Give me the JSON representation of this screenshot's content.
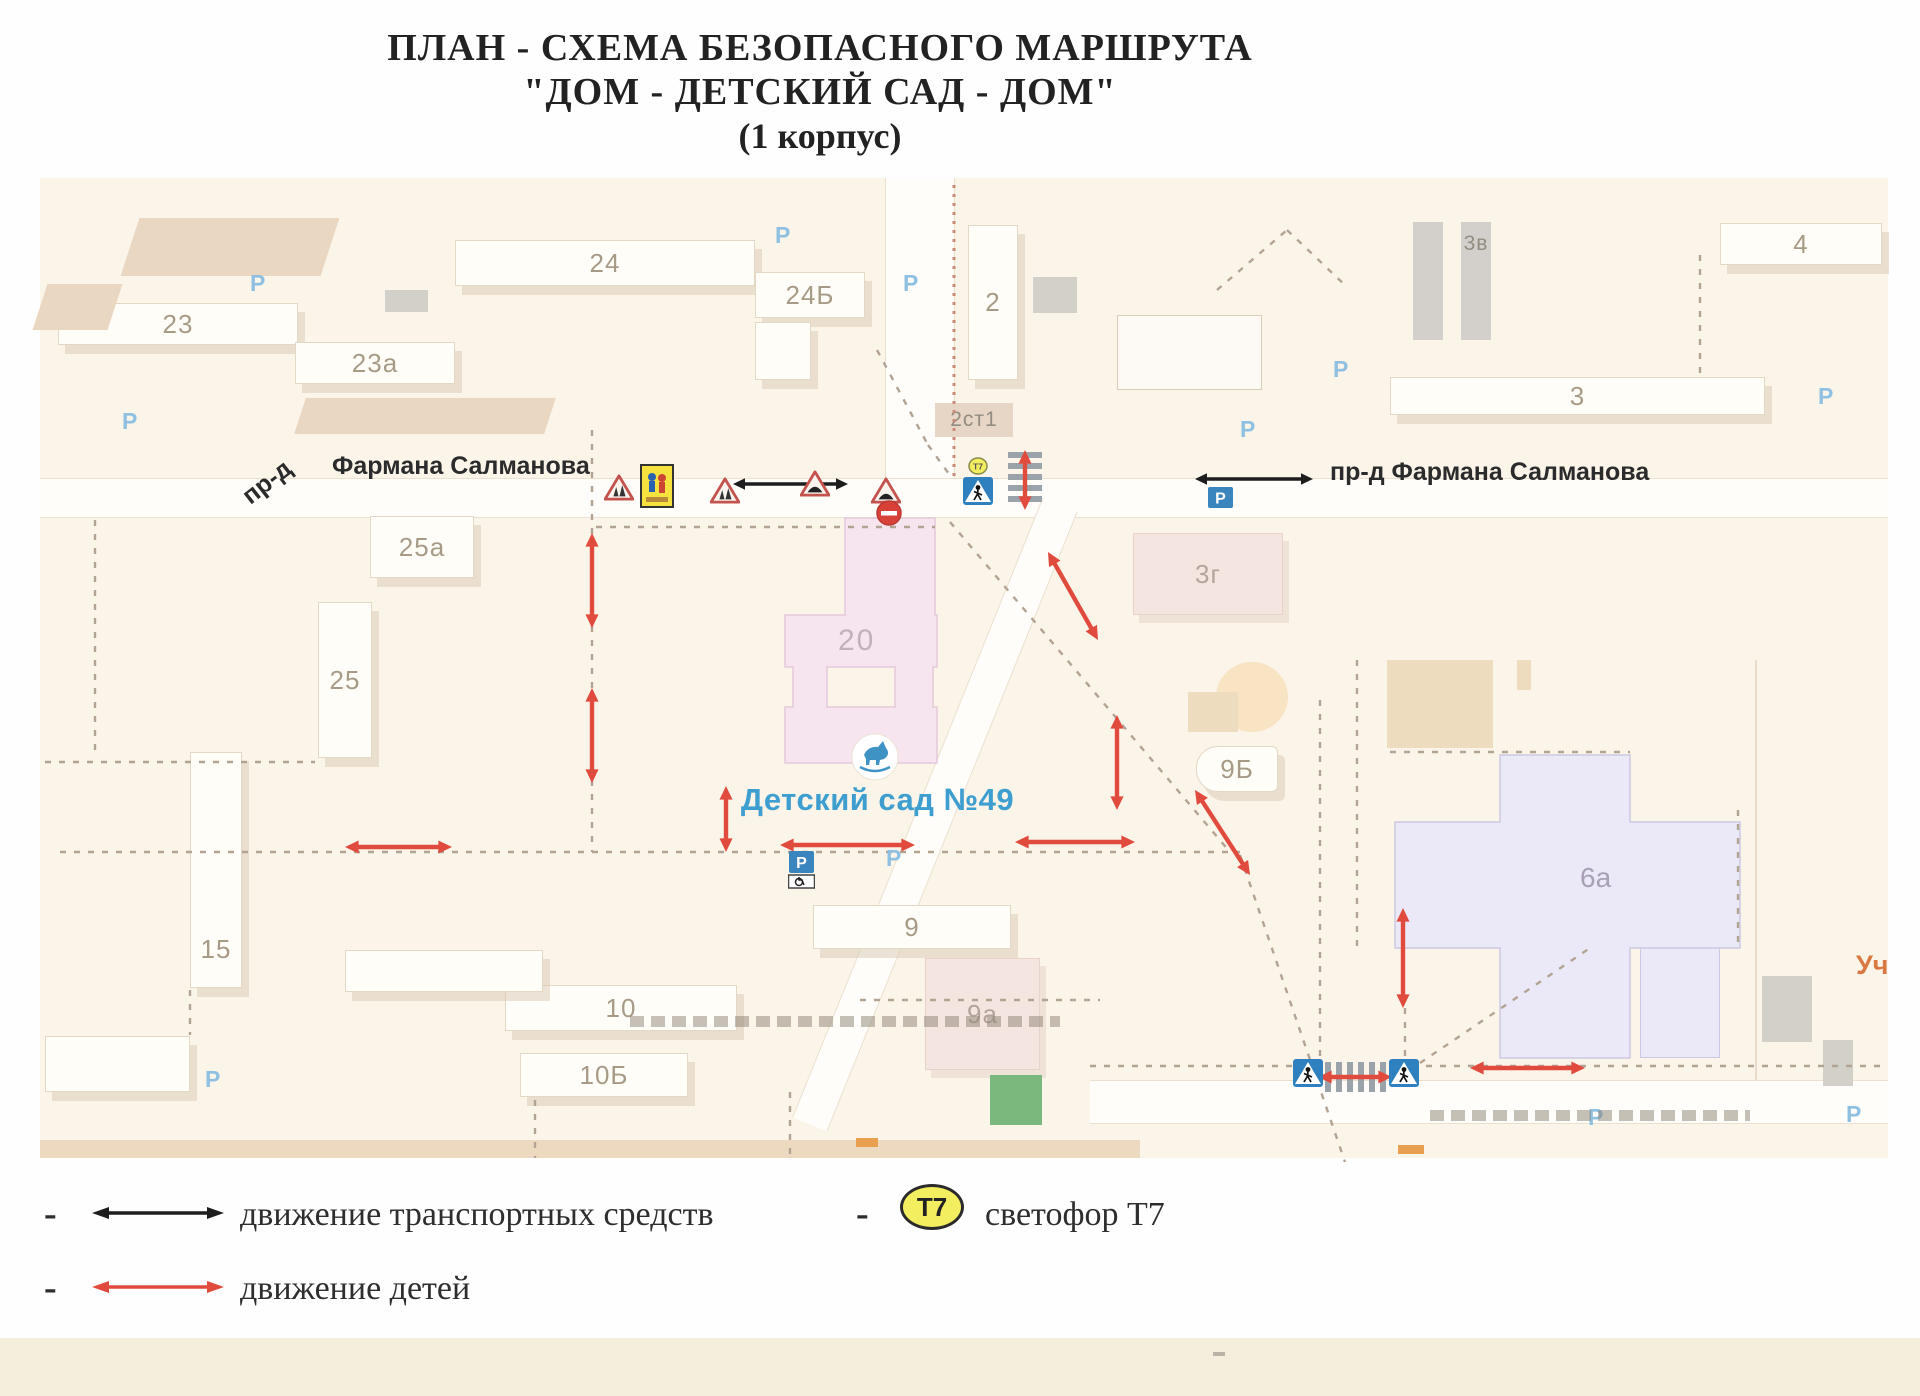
{
  "title": {
    "line1": "ПЛАН - СХЕМА БЕЗОПАСНОГО МАРШРУТА",
    "line2": "\"ДОМ - ДЕТСКИЙ САД - ДОМ\"",
    "line3": "(1 корпус)"
  },
  "legend": {
    "dash": "-",
    "vehicles_label": "движение транспортных средств",
    "children_label": "движение детей",
    "t7_label": "светофор Т7",
    "t7_badge": "Т7"
  },
  "colors": {
    "map_bg": "#fbf4e9",
    "road": "#fefdf9",
    "dash": "#b3a393",
    "red_dotted": "#cc8b7a",
    "thin": "#e2d5c2",
    "arrow_red": "#e14b3e",
    "arrow_black": "#1d1d1d",
    "zebra": "#9aa2aa",
    "kindergarten_blue": "#3d9ecf",
    "parking_blue": "#3a85bd",
    "faint_p": "#8fc0e2",
    "t7_yellow": "#f3ee5f"
  },
  "map": {
    "street_left_prefix": "пр-д",
    "street_left": "Фармана Салманова",
    "street_right": "пр-д Фармана Салманова",
    "kindergarten_label": "Детский сад №49",
    "edge_label": "Уч",
    "p_char": "P",
    "t7_badge": "Т7",
    "roads": [
      {
        "x": 40,
        "y": 478,
        "w": 1848,
        "h": 40
      },
      {
        "x": 885,
        "y": 178,
        "w": 70,
        "h": 300,
        "v": true
      },
      {
        "x": 1090,
        "y": 1080,
        "w": 798,
        "h": 44
      },
      {
        "x": 1041,
        "y": 505,
        "w": 38,
        "h": 668,
        "v": true,
        "rot": 22
      }
    ],
    "buildings": [
      {
        "label": "23",
        "x": 58,
        "y": 303,
        "w": 240,
        "h": 42,
        "t": "white"
      },
      {
        "label": "23а",
        "x": 295,
        "y": 342,
        "w": 160,
        "h": 42,
        "t": "white"
      },
      {
        "label": "24",
        "x": 455,
        "y": 240,
        "w": 300,
        "h": 46,
        "t": "white"
      },
      {
        "label": "24Б",
        "x": 755,
        "y": 272,
        "w": 110,
        "h": 46,
        "t": "white"
      },
      {
        "label": "",
        "x": 755,
        "y": 322,
        "w": 56,
        "h": 58,
        "t": "white"
      },
      {
        "label": "2",
        "x": 968,
        "y": 225,
        "w": 50,
        "h": 155,
        "t": "white"
      },
      {
        "label": "2ст1",
        "x": 935,
        "y": 403,
        "w": 78,
        "h": 34,
        "t": "tanlabel"
      },
      {
        "label": "",
        "x": 1413,
        "y": 222,
        "w": 30,
        "h": 118,
        "t": "graybar"
      },
      {
        "label": "3в",
        "x": 1461,
        "y": 222,
        "w": 30,
        "h": 118,
        "t": "graybar",
        "la": "top"
      },
      {
        "label": "3",
        "x": 1390,
        "y": 377,
        "w": 375,
        "h": 38,
        "t": "white"
      },
      {
        "label": "4",
        "x": 1720,
        "y": 223,
        "w": 162,
        "h": 42,
        "t": "white"
      },
      {
        "label": "",
        "x": 1117,
        "y": 315,
        "w": 145,
        "h": 75,
        "t": "outline"
      },
      {
        "label": "25а",
        "x": 370,
        "y": 516,
        "w": 104,
        "h": 62,
        "t": "white"
      },
      {
        "label": "25",
        "x": 318,
        "y": 602,
        "w": 54,
        "h": 156,
        "t": "white"
      },
      {
        "label": "15",
        "x": 190,
        "y": 752,
        "w": 52,
        "h": 236,
        "t": "white",
        "la": "bottom"
      },
      {
        "label": "3г",
        "x": 1133,
        "y": 533,
        "w": 150,
        "h": 82,
        "t": "pinkpale"
      },
      {
        "label": "9Б",
        "x": 1196,
        "y": 746,
        "w": 82,
        "h": 46,
        "t": "white",
        "r": "22px 6px 6px 22px"
      },
      {
        "label": "9",
        "x": 813,
        "y": 905,
        "w": 198,
        "h": 44,
        "t": "white"
      },
      {
        "label": "9а",
        "x": 925,
        "y": 958,
        "w": 115,
        "h": 112,
        "t": "pinkpale"
      },
      {
        "label": "10",
        "x": 505,
        "y": 985,
        "w": 232,
        "h": 46,
        "t": "white"
      },
      {
        "label": "",
        "x": 345,
        "y": 950,
        "w": 198,
        "h": 42,
        "t": "white"
      },
      {
        "label": "10Б",
        "x": 520,
        "y": 1053,
        "w": 168,
        "h": 44,
        "t": "white"
      },
      {
        "label": "",
        "x": 45,
        "y": 1036,
        "w": 145,
        "h": 56,
        "t": "white"
      },
      {
        "label": "",
        "x": 1387,
        "y": 660,
        "w": 106,
        "h": 88,
        "t": "tan"
      },
      {
        "label": "",
        "x": 1216,
        "y": 662,
        "w": 72,
        "h": 70,
        "t": "circle"
      },
      {
        "label": "",
        "x": 1188,
        "y": 692,
        "w": 50,
        "h": 40,
        "t": "tan"
      },
      {
        "label": "",
        "x": 1517,
        "y": 660,
        "w": 14,
        "h": 30,
        "t": "tan"
      },
      {
        "label": "",
        "x": 1640,
        "y": 942,
        "w": 80,
        "h": 116,
        "t": "lavender"
      },
      {
        "label": "",
        "x": 1762,
        "y": 976,
        "w": 50,
        "h": 66,
        "t": "gray2"
      },
      {
        "label": "",
        "x": 1823,
        "y": 1040,
        "w": 30,
        "h": 46,
        "t": "gray2"
      },
      {
        "label": "",
        "x": 385,
        "y": 290,
        "w": 43,
        "h": 22,
        "t": "gray2"
      },
      {
        "label": "",
        "x": 1033,
        "y": 277,
        "w": 44,
        "h": 36,
        "t": "gray2"
      },
      {
        "label": "",
        "x": 990,
        "y": 1075,
        "w": 52,
        "h": 50,
        "t": "green"
      },
      {
        "label": "",
        "x": 130,
        "y": 218,
        "w": 200,
        "h": 58,
        "t": "tanskew"
      },
      {
        "label": "",
        "x": 40,
        "y": 284,
        "w": 75,
        "h": 46,
        "t": "tanskew"
      },
      {
        "label": "",
        "x": 300,
        "y": 398,
        "w": 250,
        "h": 36,
        "t": "tanskew"
      }
    ],
    "b20": {
      "label": "20",
      "outer": "M845,518 L935,518 L935,615 L937,615 L937,667 L933,667 L933,707 L937,707 L937,763 L785,763 L785,707 L793,707 L793,667 L785,667 L785,615 L845,615 Z",
      "hole": "M827,667 L895,667 L895,707 L827,707 Z"
    },
    "b6a": {
      "label": "6а",
      "path": "M1500,755 L1630,755 L1630,822 L1740,822 L1740,948 L1630,948 L1630,1058 L1500,1058 L1500,948 L1395,948 L1395,822 L1500,822 Z"
    },
    "dashes": [
      [
        592,
        430,
        592,
        852
      ],
      [
        596,
        527,
        935,
        527
      ],
      [
        60,
        852,
        1240,
        852
      ],
      [
        950,
        522,
        1230,
        852
      ],
      [
        1240,
        855,
        1345,
        1162
      ],
      [
        95,
        520,
        95,
        758
      ],
      [
        45,
        762,
        315,
        762
      ],
      [
        1090,
        1066,
        1292,
        1066
      ],
      [
        1398,
        1066,
        1880,
        1066
      ],
      [
        1700,
        255,
        1700,
        375
      ],
      [
        1217,
        290,
        1287,
        230
      ],
      [
        1287,
        230,
        1347,
        287
      ],
      [
        877,
        350,
        928,
        445
      ],
      [
        928,
        445,
        952,
        478
      ],
      [
        1320,
        700,
        1320,
        1075
      ],
      [
        1357,
        660,
        1357,
        950
      ],
      [
        1390,
        752,
        1630,
        752
      ],
      [
        1738,
        810,
        1738,
        947
      ],
      [
        1420,
        1063,
        1590,
        948
      ],
      [
        1405,
        1008,
        1405,
        1060
      ],
      [
        860,
        1000,
        1100,
        1000
      ],
      [
        790,
        1092,
        790,
        1156
      ],
      [
        535,
        1100,
        535,
        1158
      ],
      [
        190,
        990,
        190,
        1035
      ]
    ],
    "red_dotted": [
      954,
      185,
      954,
      478
    ],
    "thin_lines": [
      [
        1756,
        660,
        1756,
        1080
      ]
    ],
    "red_arrows": [
      [
        592,
        533,
        592,
        628
      ],
      [
        592,
        688,
        592,
        783
      ],
      [
        726,
        786,
        726,
        852
      ],
      [
        345,
        847,
        452,
        847
      ],
      [
        780,
        845,
        915,
        845
      ],
      [
        1015,
        842,
        1135,
        842
      ],
      [
        1117,
        715,
        1117,
        810
      ],
      [
        1048,
        552,
        1098,
        640
      ],
      [
        1195,
        790,
        1250,
        875
      ],
      [
        1403,
        908,
        1403,
        1008
      ],
      [
        1318,
        1077,
        1392,
        1077
      ],
      [
        1470,
        1068,
        1585,
        1068
      ],
      [
        1025,
        450,
        1025,
        510
      ]
    ],
    "black_arrows": [
      [
        733,
        484,
        848,
        484
      ],
      [
        1195,
        479,
        1313,
        479
      ]
    ],
    "zebras": [
      {
        "x": 1008,
        "y": 452,
        "w": 34,
        "h": 56,
        "dir": "h"
      },
      {
        "x": 1325,
        "y": 1062,
        "w": 62,
        "h": 30,
        "dir": "v"
      }
    ],
    "signs": [
      {
        "t": "warn-children",
        "x": 604,
        "y": 474
      },
      {
        "t": "plate-children",
        "x": 640,
        "y": 464
      },
      {
        "t": "warn-children",
        "x": 710,
        "y": 477
      },
      {
        "t": "warn-hump",
        "x": 800,
        "y": 470
      },
      {
        "t": "warn-hump",
        "x": 871,
        "y": 477
      },
      {
        "t": "no-entry",
        "x": 876,
        "y": 500
      },
      {
        "t": "t7",
        "x": 968,
        "y": 457
      },
      {
        "t": "ped",
        "x": 963,
        "y": 477
      },
      {
        "t": "parking",
        "x": 1208,
        "y": 487
      },
      {
        "t": "parking-disabled",
        "x": 788,
        "y": 851
      },
      {
        "t": "ped",
        "x": 1293,
        "y": 1059
      },
      {
        "t": "ped",
        "x": 1389,
        "y": 1059
      }
    ],
    "p_letters": [
      [
        250,
        270
      ],
      [
        775,
        222
      ],
      [
        903,
        270
      ],
      [
        1240,
        416
      ],
      [
        1818,
        383
      ],
      [
        886,
        845
      ],
      [
        1588,
        1104
      ],
      [
        1846,
        1101
      ],
      [
        205,
        1066
      ],
      [
        1333,
        356
      ],
      [
        122,
        408
      ]
    ],
    "captions": [
      [
        630,
        1016,
        430
      ],
      [
        1430,
        1110,
        320
      ]
    ],
    "orange_bits": [
      [
        1398,
        1145,
        26,
        9
      ],
      [
        856,
        1138,
        22,
        9
      ]
    ]
  }
}
